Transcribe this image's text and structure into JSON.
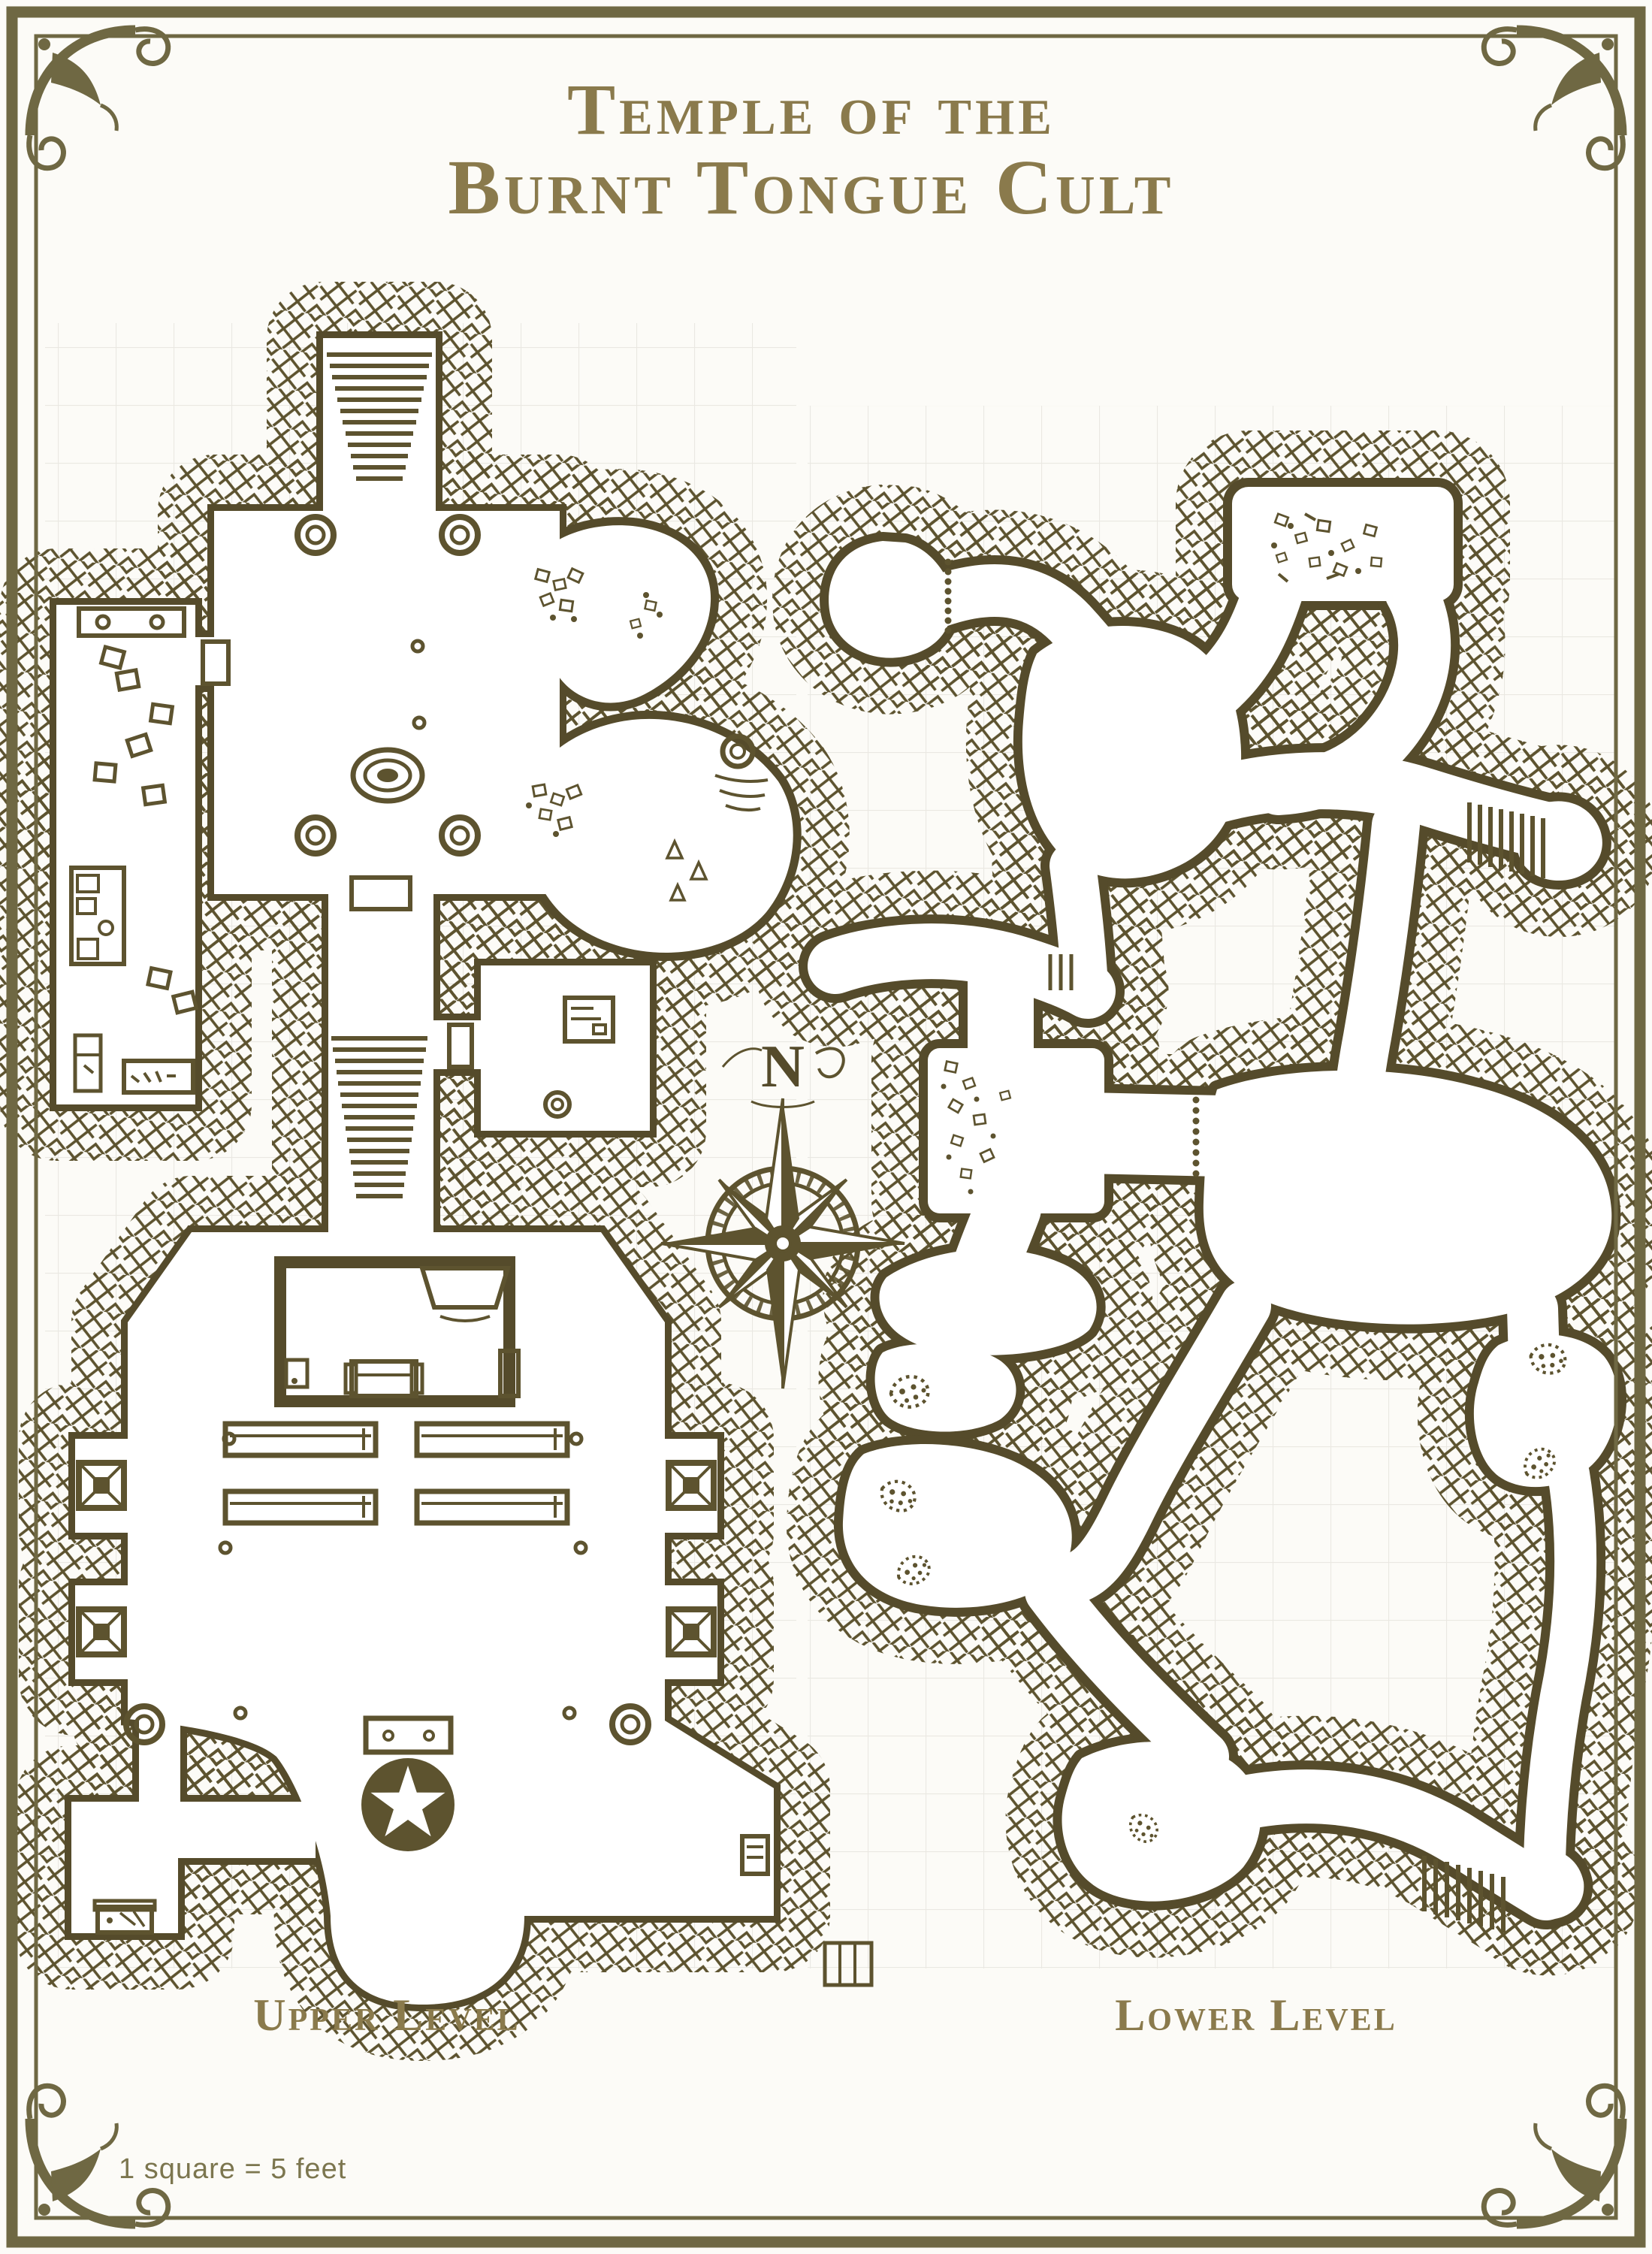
{
  "page": {
    "colors": {
      "paper": "#fcfbf7",
      "ink": "#5d532f",
      "inkDark": "#554b2b",
      "accent": "#8a7a4c",
      "border": "#6f6843",
      "grid": "#e8e6e0",
      "scaleInk": "#7c764f"
    }
  },
  "title": {
    "line1": "Temple of the",
    "line2": "Burnt Tongue Cult"
  },
  "compass": {
    "north_label": "N"
  },
  "levels": [
    {
      "id": "upper",
      "label": "Upper Level",
      "features": [
        "entrance-stairs",
        "pillared-hall",
        "spiral-altar",
        "storage-rooms",
        "stair-corridor",
        "side-chamber",
        "cave-pockets",
        "great-hall",
        "inner-chamber",
        "hearth",
        "couch",
        "benches",
        "alcove-pillars",
        "star-circle-sigil",
        "altar-table",
        "apse",
        "treasure-chest",
        "wall-sconce"
      ]
    },
    {
      "id": "lower",
      "label": "Lower Level",
      "features": [
        "cave-entrance",
        "dotted-doors",
        "rubble-room",
        "central-cavern",
        "east-stairs",
        "debris-chamber",
        "moss-patches",
        "winding-passages",
        "south-stairs"
      ]
    }
  ],
  "legend": {
    "scale_note": "1 square = 5 feet"
  }
}
